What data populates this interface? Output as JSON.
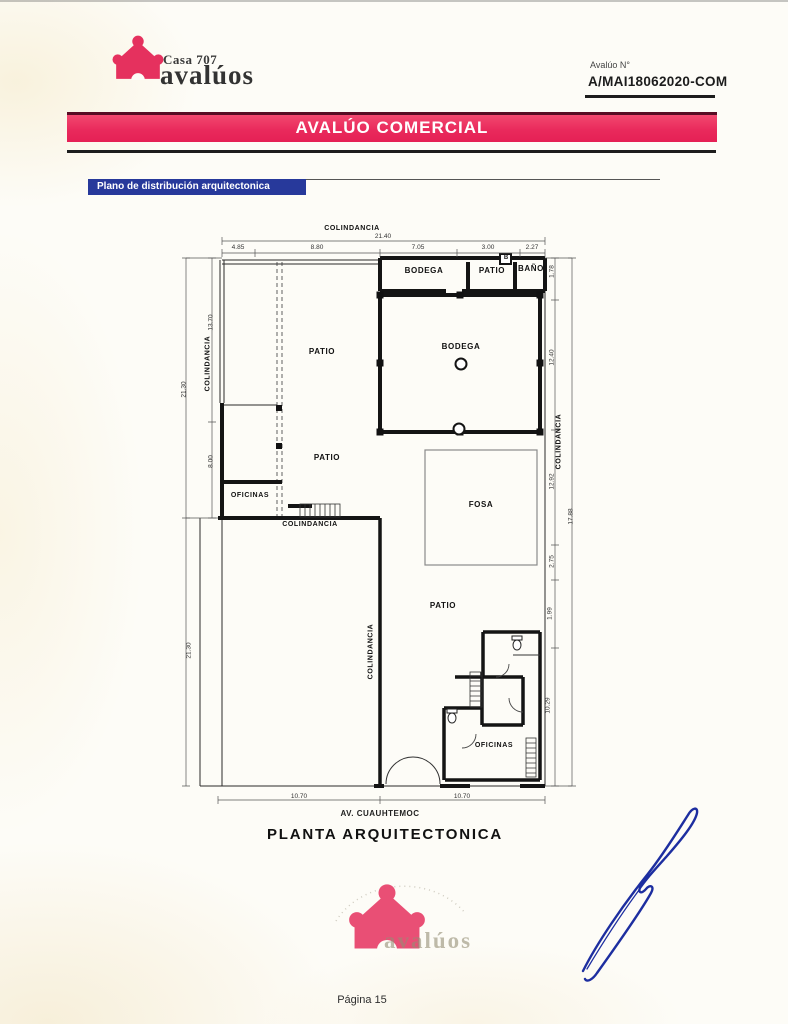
{
  "document": {
    "brand": {
      "name_line1": "Casa 707",
      "name_line2": "avalúos"
    },
    "header": {
      "avaluo_label": "Avalúo N°",
      "avaluo_number": "A/MAI18062020-COM"
    },
    "banner": {
      "title": "AVALÚO COMERCIAL"
    },
    "section_label": "Plano de distribución arquitectonica",
    "footer_page": "Página 15",
    "watermark": {
      "brand_text": "avalúos"
    }
  },
  "colors": {
    "brand_pink": "#e5315e",
    "banner_pink": "#e92a5c",
    "section_blue": "#27399b",
    "signature_blue": "#1d2ea0"
  },
  "plan": {
    "caption": "PLANTA ARQUITECTONICA",
    "street": "AV. CUAUHTEMOC",
    "boundary_label": "COLINDANCIA",
    "rooms": {
      "strip_bodega": "BODEGA",
      "strip_patio": "PATIO",
      "strip_bano": "BAÑO",
      "patio_upper": "PATIO",
      "bodega_main": "BODEGA",
      "patio_mid": "PATIO",
      "oficinas_left": "OFICINAS",
      "fosa": "FOSA",
      "patio_lower": "PATIO",
      "oficinas_bottom": "OFICINAS",
      "boiler_box": "B"
    },
    "dimensions": {
      "top_total": "21.40",
      "top_segments": [
        "4.85",
        "8.80",
        "7.05",
        "3.00",
        "2.27"
      ],
      "left_outer_upper": "21.30",
      "left_inner_upper": "13.70",
      "left_inner_lower": "8.00",
      "left_outer_lower": "21.30",
      "right_segments": [
        "1.78",
        "12.40",
        "12.92",
        "2.75",
        "1.99",
        "10.29"
      ],
      "right_outer": "17.88",
      "bottom_segments": [
        "10.70",
        "10.70"
      ]
    }
  }
}
